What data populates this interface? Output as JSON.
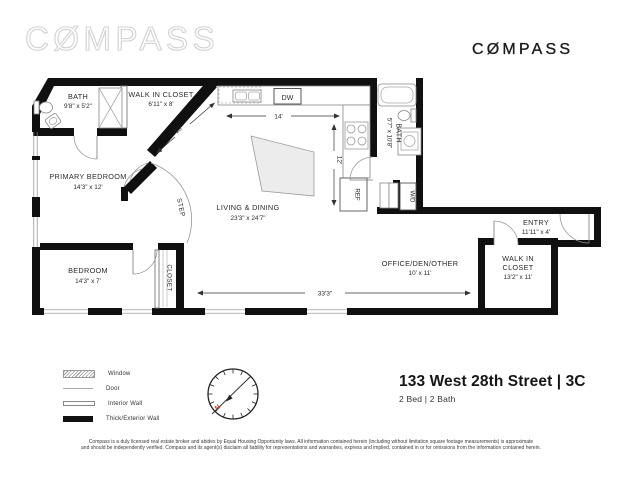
{
  "brand": {
    "logo_text": "CØMPASS"
  },
  "title_block": {
    "address": "133 West 28th Street | 3C",
    "specs": "2 Bed | 2 Bath"
  },
  "floorplan": {
    "rooms": {
      "bath_1": {
        "name": "BATH",
        "dims": "9'8\" x 5'2\""
      },
      "walk_in_closet_1": {
        "name": "WALK IN CLOSET",
        "dims": "6'11\" x 8'"
      },
      "primary_bedroom": {
        "name": "PRIMARY BEDROOM",
        "dims": "14'3\" x 12'"
      },
      "living_dining": {
        "name": "LIVING & DINING",
        "dims": "23'3\" x 24'7\""
      },
      "bedroom": {
        "name": "BEDROOM",
        "dims": "14'3\" x 7'"
      },
      "office_den": {
        "name": "OFFICE/DEN/OTHER",
        "dims": "10' x 11'"
      },
      "entry": {
        "name": "ENTRY",
        "dims": "11'11\" x 4'"
      },
      "walk_in_closet_2": {
        "name_line1": "WALK IN",
        "name_line2": "CLOSET",
        "dims": "13'2\" x 11'"
      },
      "bath_2": {
        "name": "BATH",
        "dims": "5'7\" x 10'8\""
      }
    },
    "fixtures": {
      "dishwasher": "DW",
      "refrigerator": "REF",
      "washer_dryer": "W/D",
      "step": "STEP",
      "closet": "CLOSET"
    },
    "dimensions": {
      "kitchen_width": "14'",
      "closet_diagonal": "10'",
      "kitchen_depth": "12'",
      "south_wall": "33'3\""
    }
  },
  "legend": {
    "items": [
      {
        "label": "Window"
      },
      {
        "label": "Door"
      },
      {
        "label": "Interior Wall"
      },
      {
        "label": "Thick/Exterior Wall"
      }
    ]
  },
  "compass_rose": {
    "north_label": "N"
  },
  "disclaimer": {
    "line1": "Compass is a duly licensed real estate broker and abides by Equal Housing Opportunity laws. All information contained herein (including without limitation square footage measurements) is approximate",
    "line2": "and should be independently verified. Compass and its agent(s) disclaim all liability for representations and warranties, express and implied, contained in or for omissions from the information contained herein."
  }
}
